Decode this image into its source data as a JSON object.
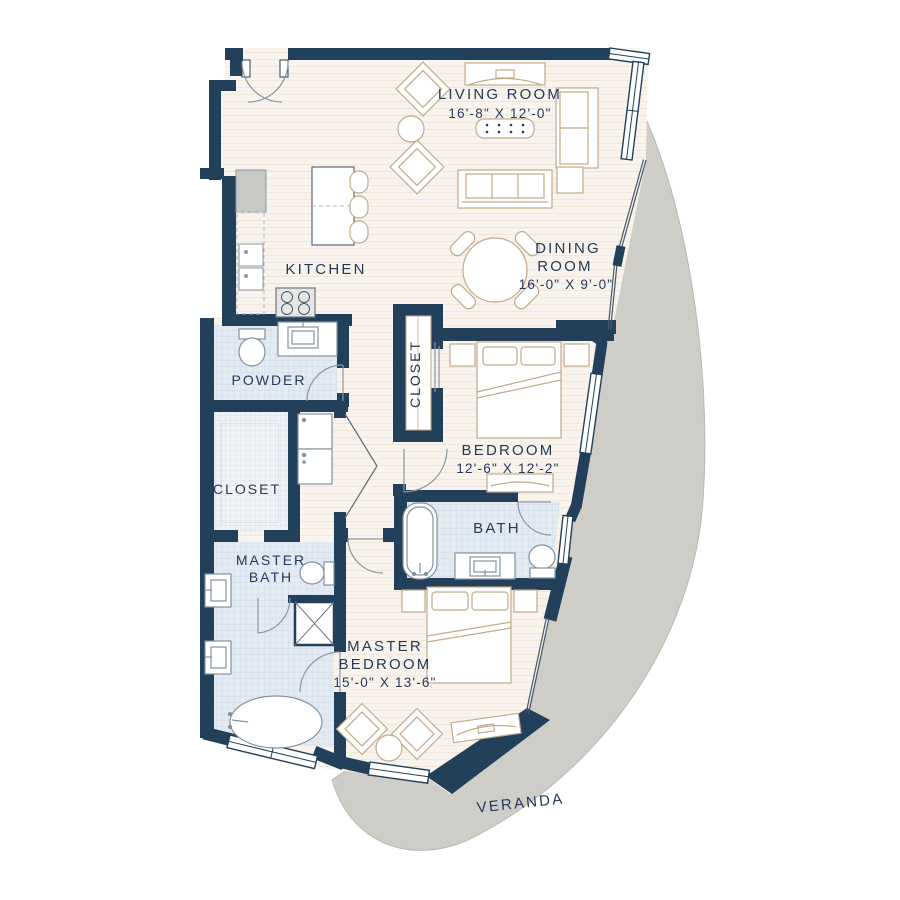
{
  "floor_plan": {
    "rooms": {
      "living_room": {
        "name": "LIVING ROOM",
        "dimensions": "16'-8\" X 12'-0\""
      },
      "dining_room": {
        "name_line1": "DINING",
        "name_line2": "ROOM",
        "dimensions": "16'-0\" X 9'-0\""
      },
      "kitchen": {
        "name": "KITCHEN"
      },
      "powder": {
        "name": "POWDER"
      },
      "master_closet": {
        "name": "CLOSET"
      },
      "bedroom_closet": {
        "name": "CLOSET"
      },
      "bedroom": {
        "name": "BEDROOM",
        "dimensions": "12'-6\" X 12'-2\""
      },
      "bath": {
        "name": "BATH"
      },
      "master_bath": {
        "name_line1": "MASTER",
        "name_line2": "BATH"
      },
      "master_bedroom": {
        "name_line1": "MASTER",
        "name_line2": "BEDROOM",
        "dimensions": "15'-0\" X 13'-6\""
      },
      "veranda": {
        "name": "VERANDA"
      }
    },
    "colors": {
      "wall": "#22405a",
      "floor": "#f8f3ec",
      "tile": "#e4ebf2",
      "veranda": "#cfcec9",
      "furniture_outline": "#c2aa8a",
      "fixture_outline": "#84919f",
      "label_text": "#26395a"
    }
  }
}
